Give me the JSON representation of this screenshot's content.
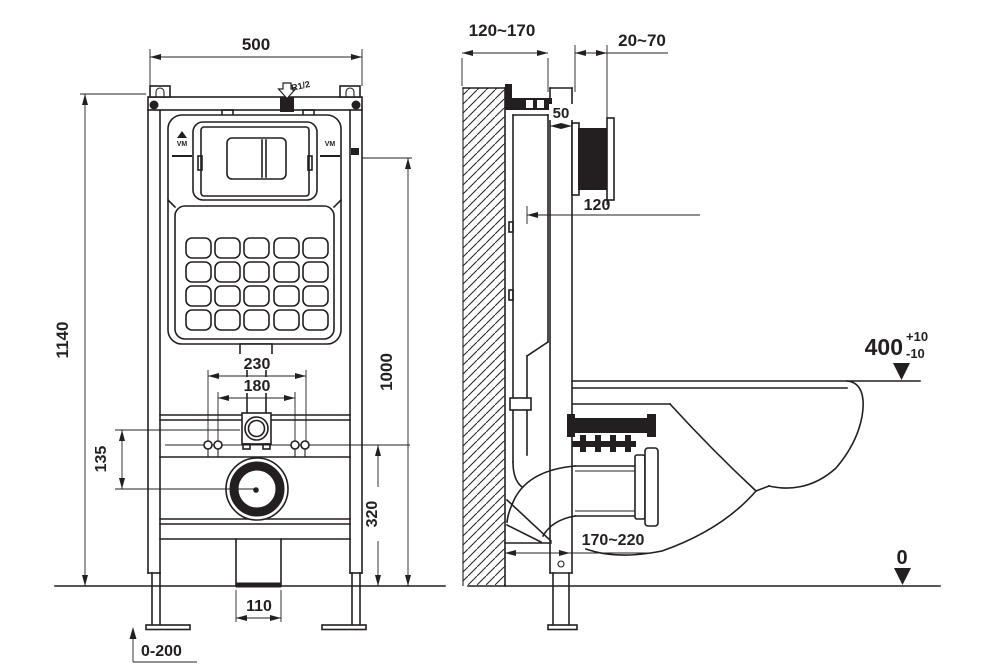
{
  "meta": {
    "drawing_type": "wall-hung-toilet-concealed-cistern-frame-installation-drawing",
    "line_color": "#231f20",
    "background_color": "#ffffff"
  },
  "front_view": {
    "labels": {
      "frame_width": "500",
      "frame_height": "1140",
      "plate_center_height": "1000",
      "fixing_spacing_outer": "230",
      "fixing_spacing_inner": "180",
      "flush_to_drain": "135",
      "fixing_height": "320",
      "drain_width": "110",
      "leg_adjustment": "0-200",
      "inlet_thread": "R1/2",
      "plate_mark_left": "VM",
      "plate_mark_right": "VM"
    }
  },
  "side_view": {
    "labels": {
      "wall_to_front": "120~170",
      "finish_thickness": "20~70",
      "profile_depth": "50",
      "cistern_depth": "120",
      "rim_height": "400",
      "rim_tol_plus": "+10",
      "rim_tol_minus": "-10",
      "floor_level": "0",
      "outlet_offset": "170~220"
    }
  }
}
